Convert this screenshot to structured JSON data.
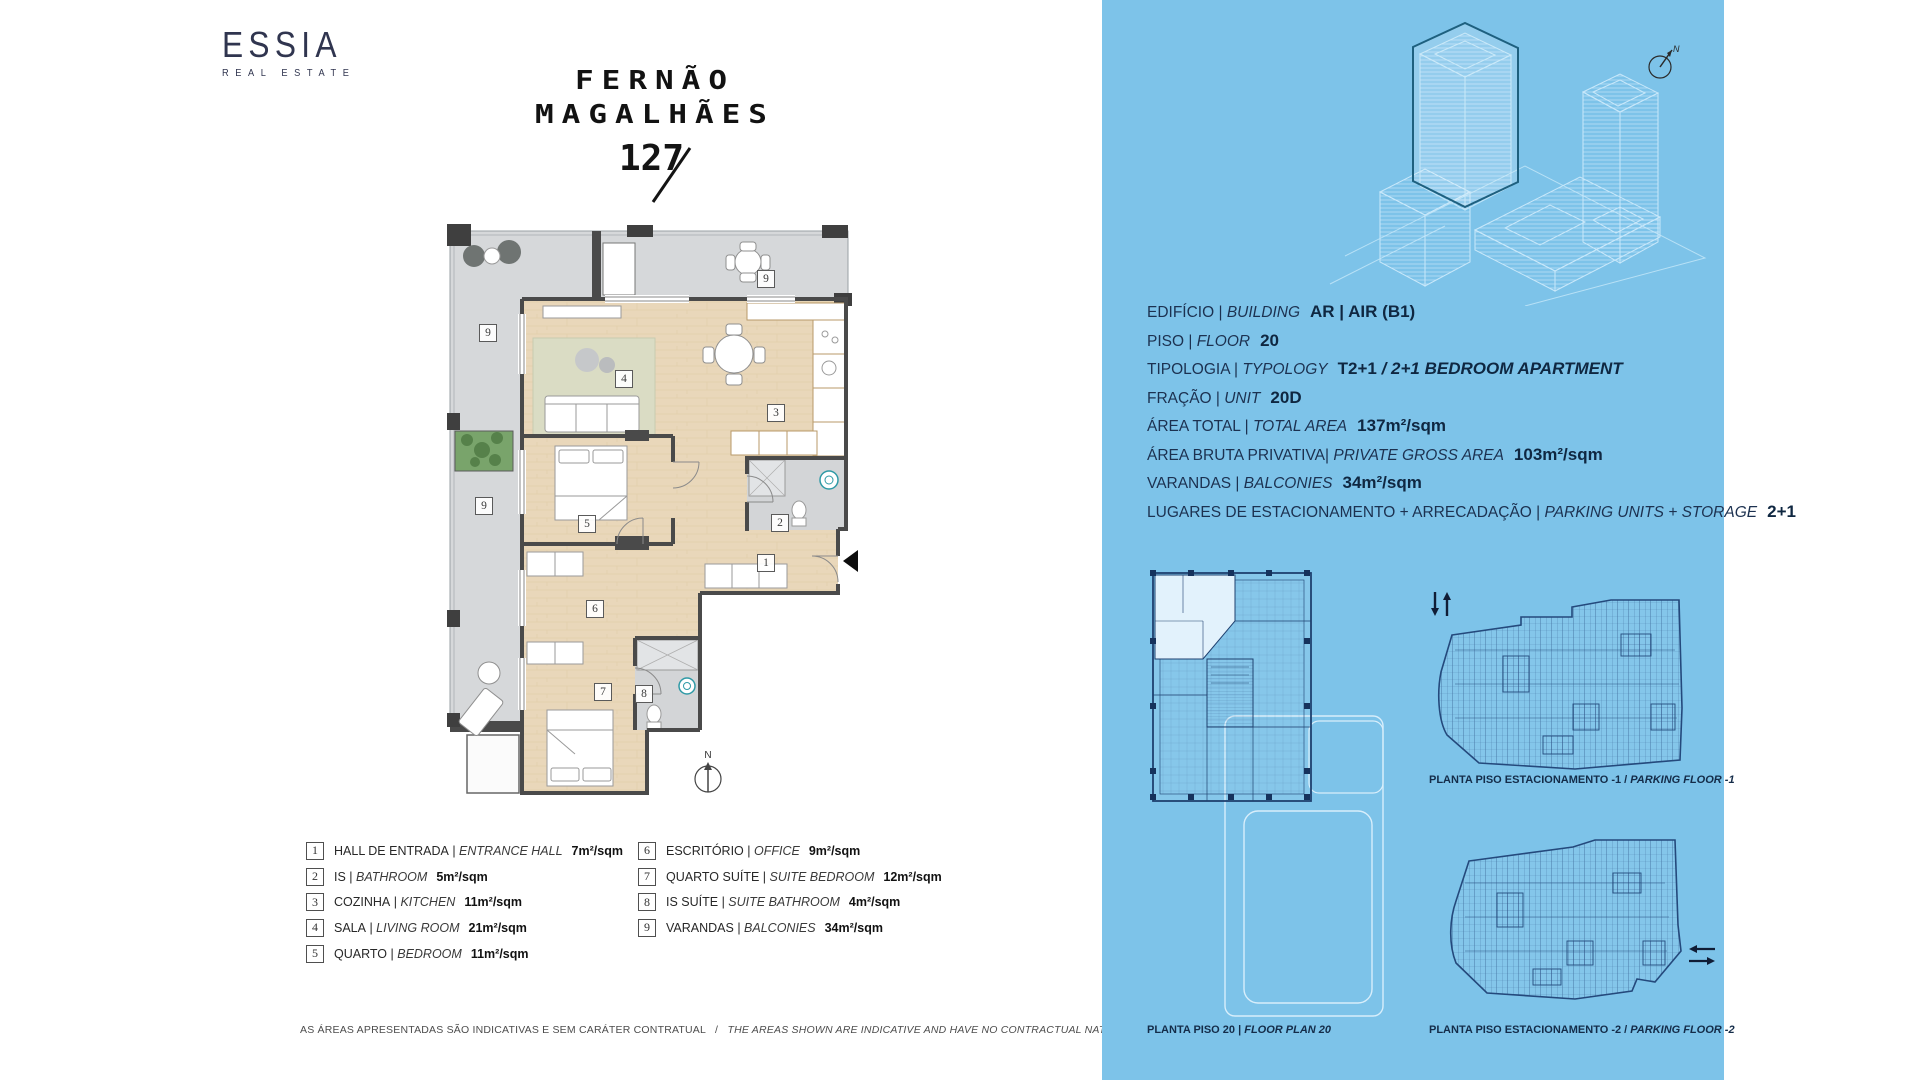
{
  "branding": {
    "logo_name": "ESSIA",
    "logo_subtitle": "REAL ESTATE",
    "project_line1": "FERNÃO",
    "project_line2": "MAGALHÃES",
    "project_number": "127"
  },
  "floor_plan": {
    "north_label": "N",
    "rooms": [
      {
        "num": "1",
        "x": 318,
        "y": 344
      },
      {
        "num": "2",
        "x": 332,
        "y": 304
      },
      {
        "num": "3",
        "x": 328,
        "y": 194
      },
      {
        "num": "4",
        "x": 176,
        "y": 160
      },
      {
        "num": "5",
        "x": 139,
        "y": 305
      },
      {
        "num": "6",
        "x": 147,
        "y": 390
      },
      {
        "num": "7",
        "x": 155,
        "y": 473
      },
      {
        "num": "8",
        "x": 196,
        "y": 475
      },
      {
        "num": "9",
        "x": 318,
        "y": 60
      },
      {
        "num": "9",
        "x": 40,
        "y": 114
      },
      {
        "num": "9",
        "x": 36,
        "y": 287
      }
    ]
  },
  "legend": {
    "columns": [
      [
        {
          "num": "1",
          "pt": "HALL DE ENTRADA",
          "sep": " | ",
          "en": "ENTRANCE HALL",
          "area": "7m²/sqm"
        },
        {
          "num": "2",
          "pt": "IS",
          "sep": " | ",
          "en": "BATHROOM",
          "area": "5m²/sqm"
        },
        {
          "num": "3",
          "pt": "COZINHA",
          "sep": " | ",
          "en": "KITCHEN",
          "area": "11m²/sqm"
        },
        {
          "num": "4",
          "pt": "SALA",
          "sep": " | ",
          "en": "LIVING ROOM",
          "area": "21m²/sqm"
        },
        {
          "num": "5",
          "pt": "QUARTO",
          "sep": " | ",
          "en": "BEDROOM",
          "area": "11m²/sqm"
        }
      ],
      [
        {
          "num": "6",
          "pt": "ESCRITÓRIO",
          "sep": " | ",
          "en": "OFFICE",
          "area": "9m²/sqm"
        },
        {
          "num": "7",
          "pt": "QUARTO SUÍTE",
          "sep": " | ",
          "en": "SUITE BEDROOM",
          "area": "12m²/sqm"
        },
        {
          "num": "8",
          "pt": "IS SUÍTE",
          "sep": " | ",
          "en": "SUITE BATHROOM",
          "area": "4m²/sqm"
        },
        {
          "num": "9",
          "pt": "VARANDAS",
          "sep": " | ",
          "en": "BALCONIES",
          "area": "34m²/sqm"
        }
      ]
    ]
  },
  "disclaimer": {
    "pt": "AS ÁREAS APRESENTADAS SÃO INDICATIVAS E SEM CARÁTER CONTRATUAL",
    "sep": "   /   ",
    "en": "THE AREAS SHOWN ARE INDICATIVE AND HAVE NO CONTRACTUAL NATURE"
  },
  "info_panel": {
    "accent_bg": "#7dc3e9",
    "compass_label": "N",
    "lines": [
      {
        "pt": "EDIFÍCIO",
        "sep": " | ",
        "en": "BUILDING",
        "value": "AR | AIR (B1)"
      },
      {
        "pt": "PISO",
        "sep": " | ",
        "en": "FLOOR",
        "value": "20"
      },
      {
        "pt": "TIPOLOGIA",
        "sep": " | ",
        "en": "TYPOLOGY",
        "value": "T2+1",
        "value2": " / 2+1 BEDROOM APARTMENT"
      },
      {
        "pt": "FRAÇÃO",
        "sep": " | ",
        "en": "UNIT",
        "value": "20D"
      },
      {
        "pt": "ÁREA TOTAL",
        "sep": " | ",
        "en": "TOTAL AREA",
        "value": "137m²/sqm"
      },
      {
        "pt": "ÁREA BRUTA PRIVATIVA",
        "sep": "| ",
        "en": "PRIVATE GROSS AREA",
        "value": "103m²/sqm"
      },
      {
        "pt": "VARANDAS",
        "sep": " | ",
        "en": "BALCONIES",
        "value": "34m²/sqm"
      },
      {
        "pt": "LUGARES DE ESTACIONAMENTO + ARRECADAÇÃO",
        "sep": " | ",
        "en": "PARKING UNITS + STORAGE",
        "value": "2+1"
      }
    ]
  },
  "mini_plans": {
    "floor20_label": {
      "pt": "PLANTA PISO 20",
      "sep": " | ",
      "en": "FLOOR PLAN 20"
    },
    "parking1_label": {
      "pt": "PLANTA PISO ESTACIONAMENTO -1",
      "sep": " / ",
      "en": "PARKING FLOOR -1"
    },
    "parking2_label": {
      "pt": "PLANTA PISO ESTACIONAMENTO -2",
      "sep": " / ",
      "en": "PARKING FLOOR -2"
    }
  }
}
